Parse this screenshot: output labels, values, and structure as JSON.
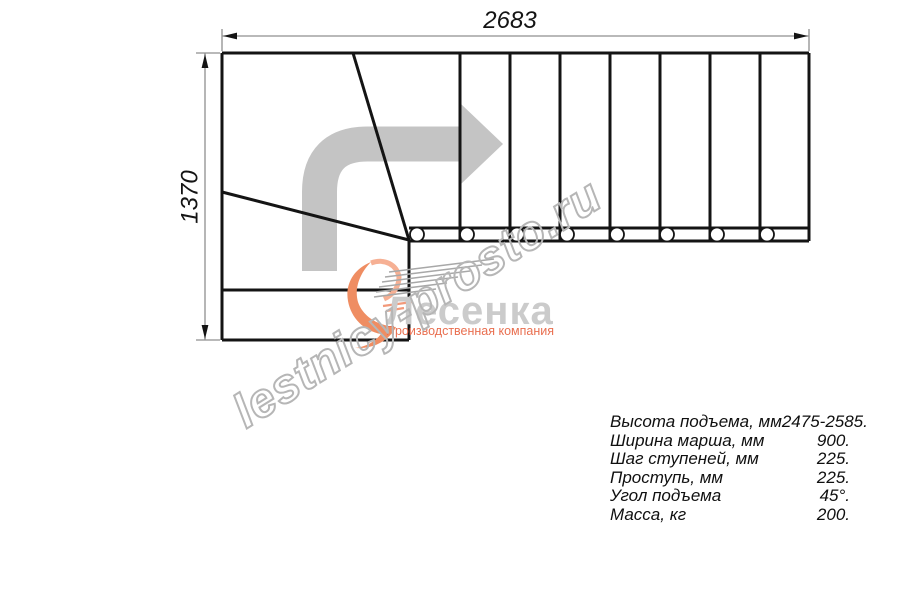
{
  "dimensions": {
    "width_label": "2683",
    "height_label": "1370"
  },
  "plan": {
    "tread_columns": 8,
    "baluster_circles": 8,
    "winder_lines": 2
  },
  "watermark": {
    "text": "lestnicy-prosto.ru",
    "outline_color": "#b6b6b6"
  },
  "logo": {
    "name": "Лесенка",
    "tagline": "Производственная компания",
    "name_color": "#cbcbcb",
    "tagline_color": "#e96f50",
    "swoosh_color": "#ef8d62"
  },
  "specs": {
    "rows": [
      {
        "label": "Высота подъема, мм",
        "value": "2475-2585."
      },
      {
        "label": "Ширина марша, мм",
        "value": "900."
      },
      {
        "label": "Шаг ступеней, мм",
        "value": "225."
      },
      {
        "label": "Проступь, мм",
        "value": "225."
      },
      {
        "label": "Угол подъема",
        "value": "45°."
      },
      {
        "label": "Масса, кг",
        "value": "200."
      }
    ]
  },
  "colors": {
    "drawing_line": "#141414",
    "dimension_line": "#8f8f8f",
    "direction_arrow": "#c4c4c4",
    "background": "#ffffff"
  }
}
